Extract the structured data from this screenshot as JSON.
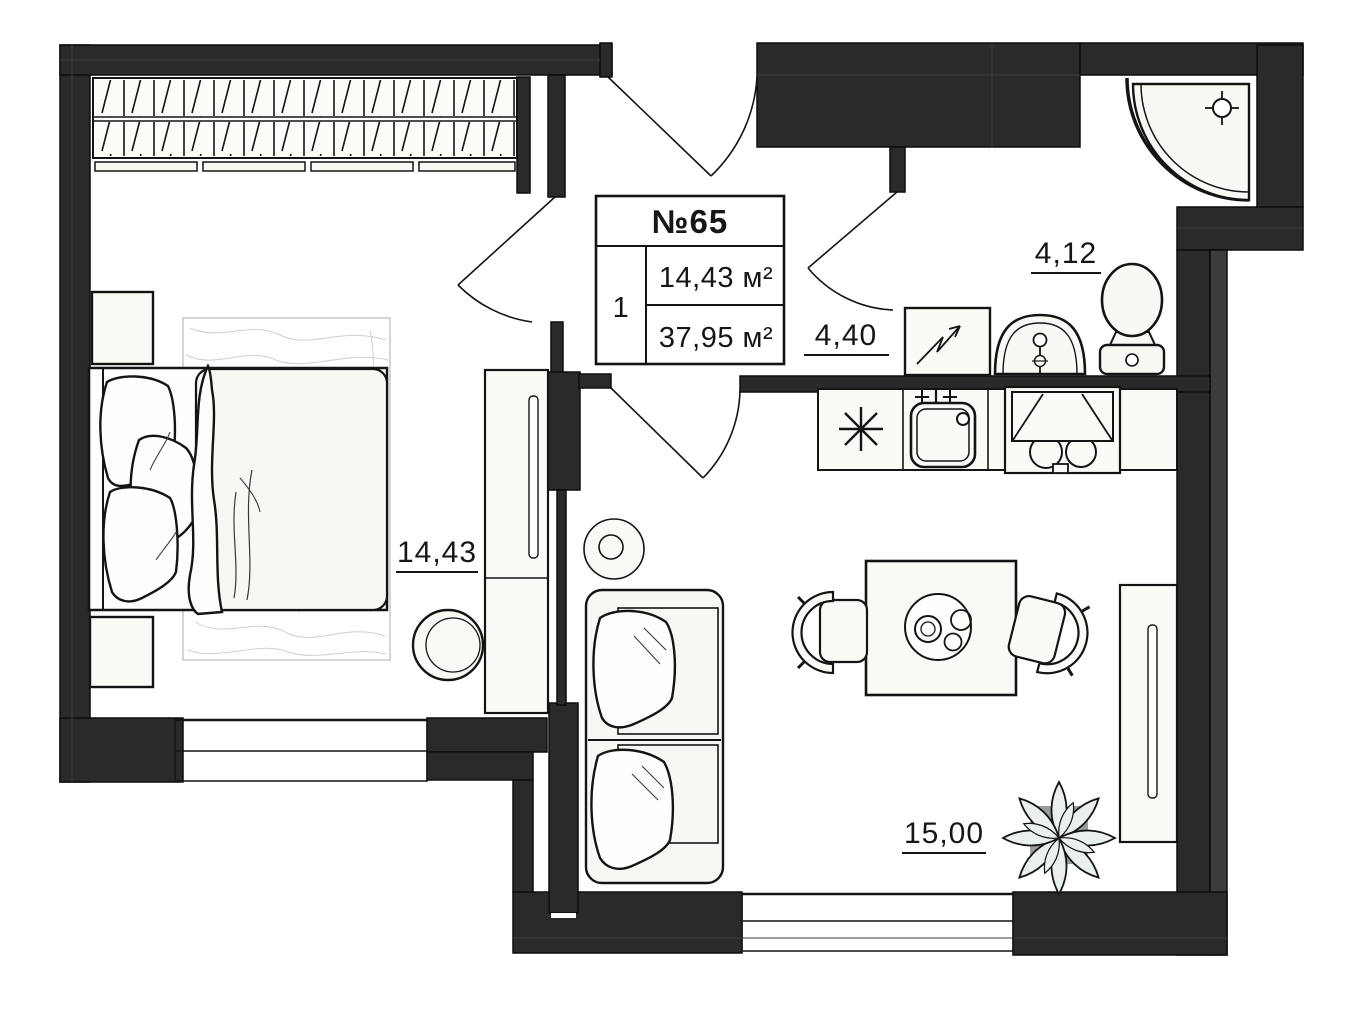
{
  "unit_card": {
    "number": "№65",
    "rooms_label": "1",
    "living_area": "14,43 м²",
    "total_area": "37,95 м²"
  },
  "room_labels": {
    "bedroom": "14,43",
    "hallway": "4,40",
    "bathroom": "4,12",
    "living_room": "15,00"
  },
  "colors": {
    "wall_dark": "#2a2a2a",
    "wall_light": "#3c3c3c",
    "outline": "#141414",
    "furniture_fill": "#f7f7f3",
    "counter_fill": "#fbfaf7",
    "plant_leaf": "#eaf0ec",
    "rug_line": "#cfcfcf",
    "background": "#ffffff"
  },
  "fixtures": [
    "wardrobe-hanging-rail",
    "double-bed",
    "rug",
    "nightstand",
    "pouf",
    "bedroom-cabinet",
    "sofa",
    "side-table",
    "dining-table",
    "chair",
    "plant",
    "tall-cabinet",
    "kitchen-counter",
    "asterisk-appliance-symbol",
    "kitchen-sink",
    "cooktop-with-hood",
    "vent-arrow-box",
    "washbasin",
    "toilet",
    "corner-shower",
    "entrance-door",
    "bedroom-door",
    "living-room-door",
    "bathroom-door",
    "window"
  ]
}
